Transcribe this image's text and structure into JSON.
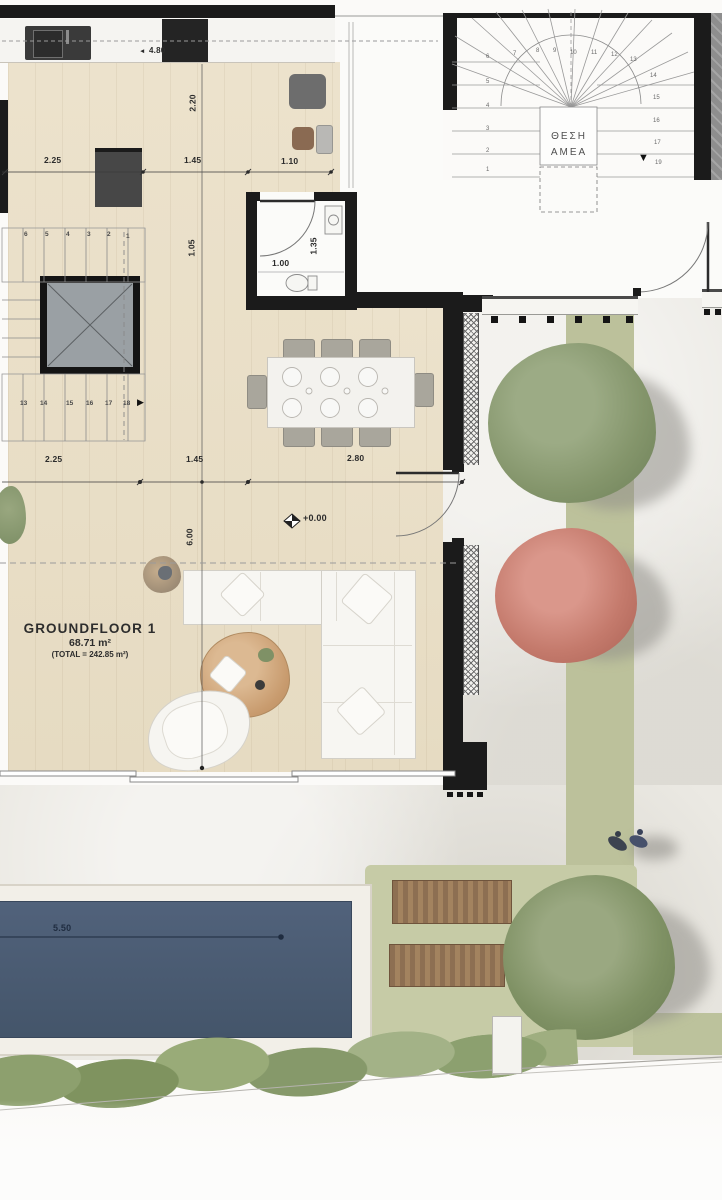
{
  "plan": {
    "title": "GROUNDFLOOR 1",
    "area": "68.71 m²",
    "total": "(TOTAL = 242.85 m²)",
    "level_marker": "+0.00",
    "parking_label_line1": "ΘΕΣΗ",
    "parking_label_line2": "ΑΜΕΑ"
  },
  "dimensions": {
    "kitchen_run_1": "2.25",
    "kitchen_run_2": "1.45",
    "kitchen_run_3": "1.10",
    "kitchen_total_width": "4.80",
    "kitchen_depth": "2.20",
    "stair_hall_depth": "1.05",
    "bath_width": "1.00",
    "bath_depth": "1.35",
    "living_run_1": "2.25",
    "living_run_2": "1.45",
    "living_run_3": "2.80",
    "living_depth": "6.00",
    "pool_length": "5.50"
  },
  "stairs": {
    "interior_upper": [
      "6",
      "5",
      "4",
      "3",
      "2",
      "1"
    ],
    "interior_lower": [
      "13",
      "14",
      "15",
      "16",
      "17",
      "18"
    ],
    "exterior_left": [
      "6",
      "5",
      "4",
      "3",
      "2",
      "1"
    ],
    "exterior_top": [
      "7",
      "8",
      "9",
      "10",
      "11",
      "12",
      "13"
    ],
    "exterior_right": [
      "14",
      "15",
      "16",
      "17"
    ],
    "exterior_bottom_step": "19"
  },
  "icons": {
    "dim_arrow_left": "◄",
    "stair_direction_right": "▶",
    "stair_direction_down": "▼"
  },
  "colors": {
    "wall": "#1b1b1b",
    "wood_floor": "#e8dec7",
    "paving": "#e9e7e1",
    "lawn": "#c6cba6",
    "planter_strip": "#bcc19b",
    "pool_water": "#4d5e74",
    "tree_green": "#84956b",
    "tree_red": "#c47a6c",
    "lounger_wood": "#97775a"
  }
}
